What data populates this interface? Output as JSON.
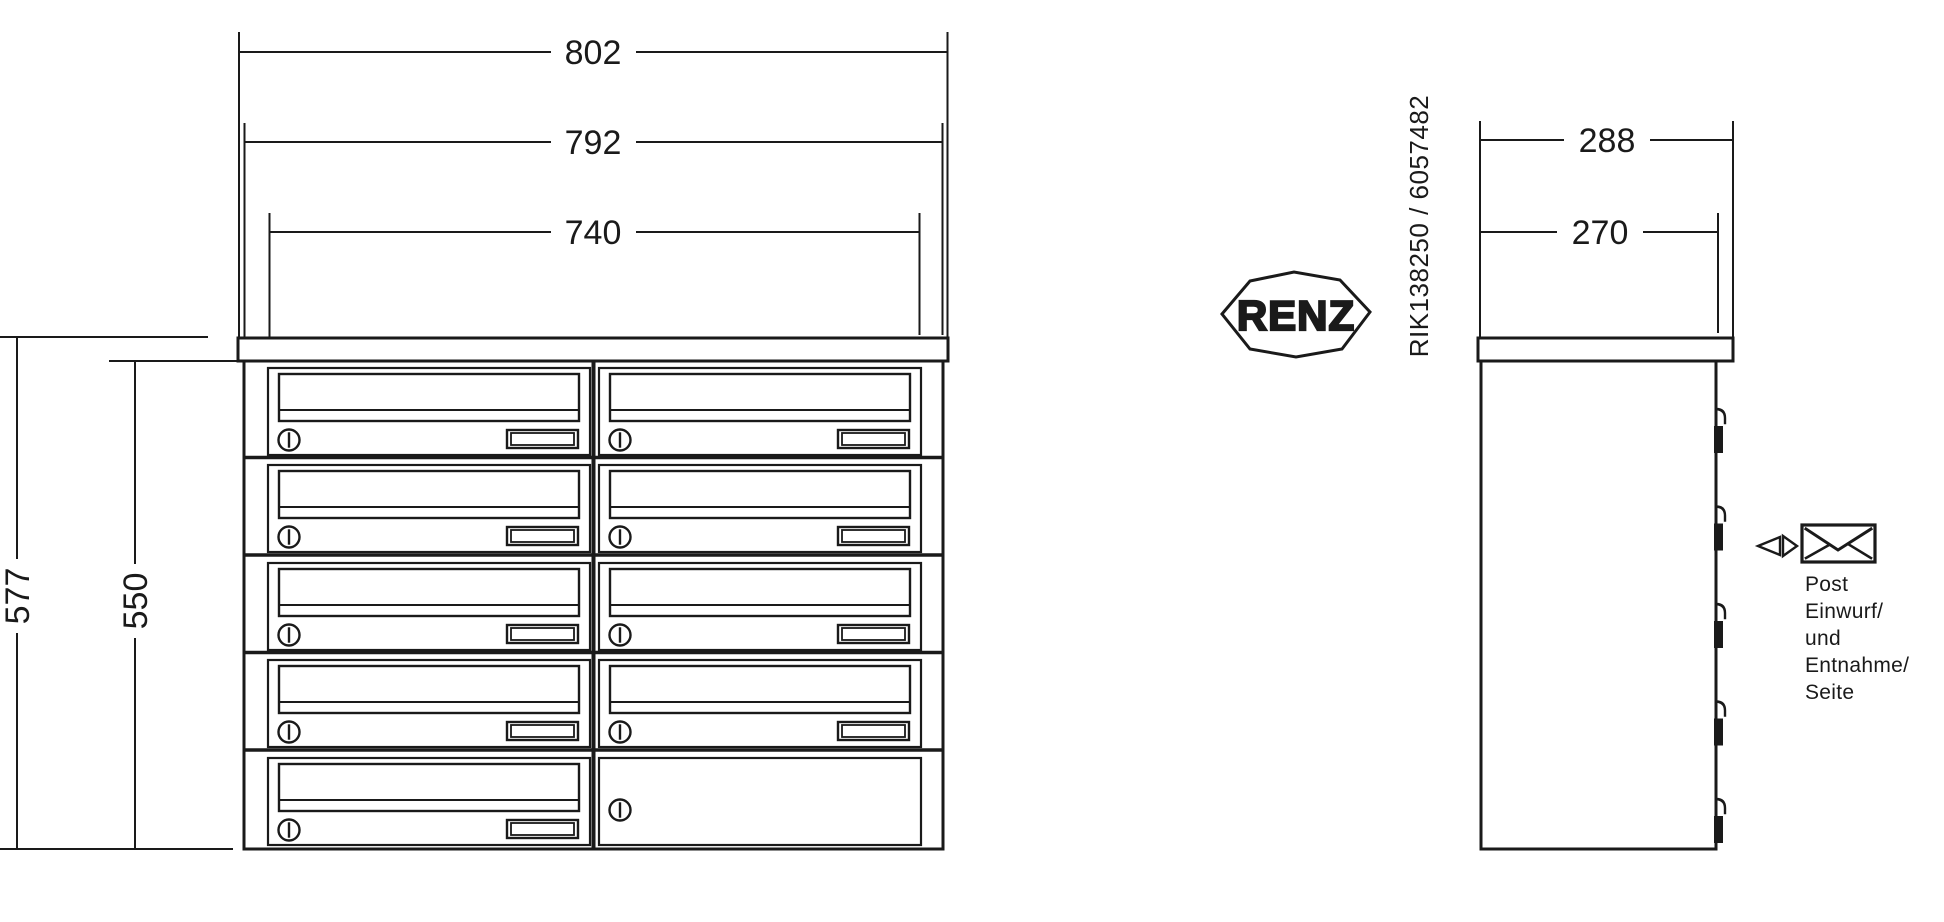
{
  "title": "RENZ letterbox bank technical drawing",
  "brand": {
    "logo_text": "RENZ"
  },
  "part_number": "RIK138250 / 6057482",
  "front_view": {
    "dim_width_overall": "802",
    "dim_width_body": "792",
    "dim_width_inner": "740",
    "dim_height_overall": "577",
    "dim_height_body": "550",
    "rows": 5,
    "columns": 2,
    "compartments": 9
  },
  "side_view": {
    "dim_depth_overall": "288",
    "dim_depth_body": "270"
  },
  "side_note": {
    "lines": [
      "Post",
      "Einwurf/",
      "und",
      "Entnahme/",
      "Seite"
    ]
  },
  "colors": {
    "line": "#1a1a1a",
    "background": "#ffffff"
  }
}
